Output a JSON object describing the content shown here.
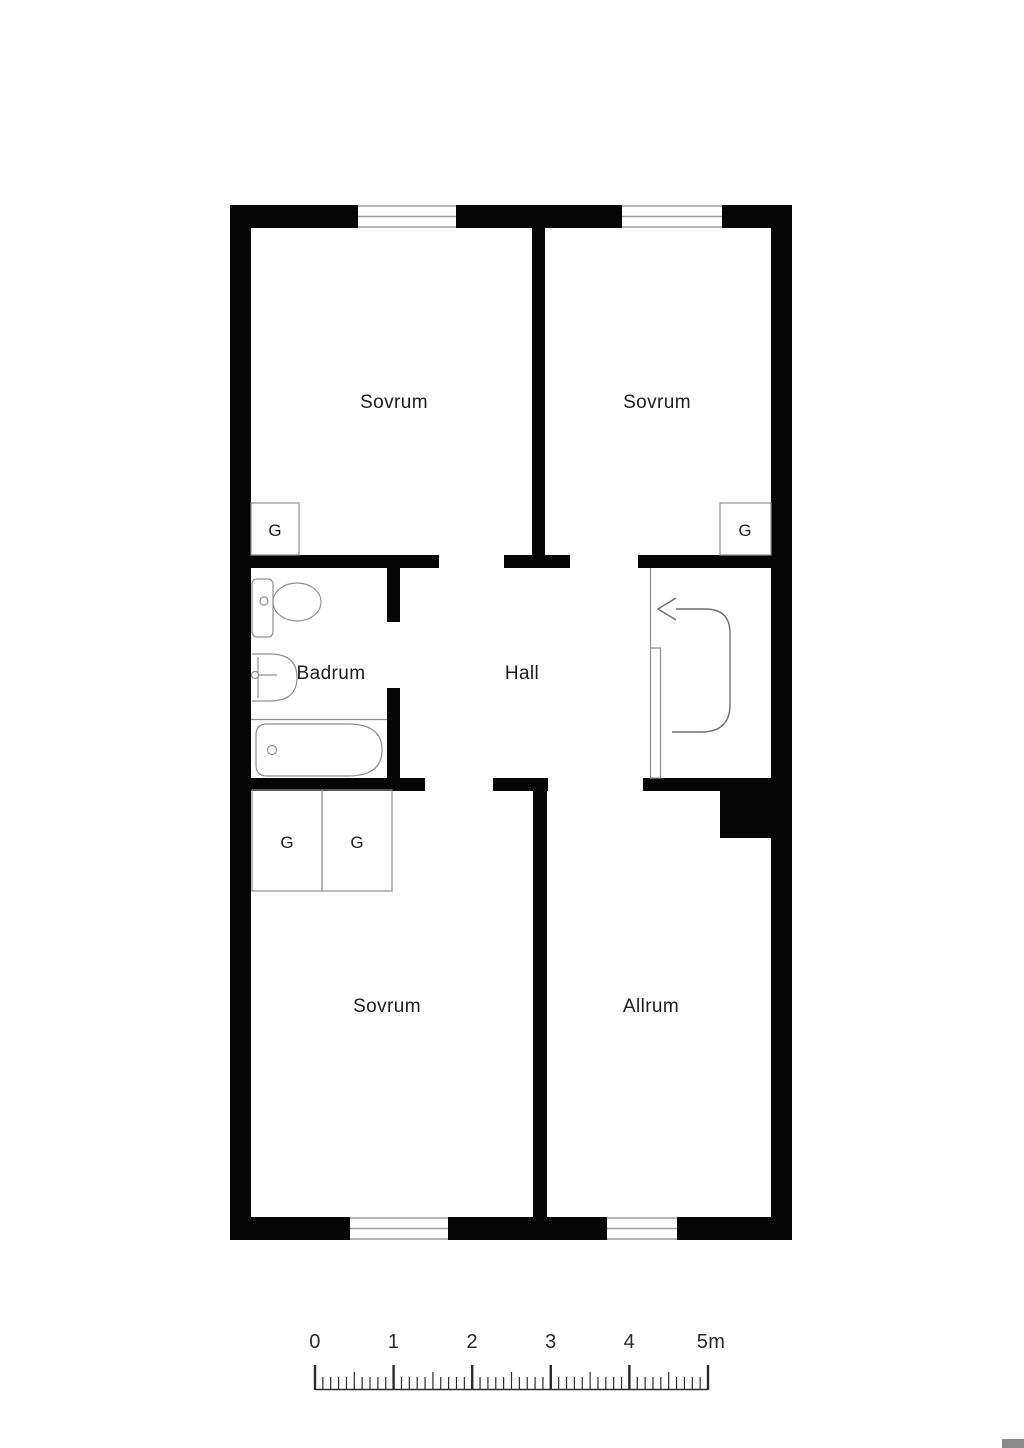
{
  "page": {
    "background": "#ffffff",
    "type_label": "floor plan"
  },
  "floorplan": {
    "rooms": [
      {
        "id": "sovrum-top-left",
        "label": "Sovrum"
      },
      {
        "id": "sovrum-top-right",
        "label": "Sovrum"
      },
      {
        "id": "badrum",
        "label": "Badrum"
      },
      {
        "id": "hall",
        "label": "Hall"
      },
      {
        "id": "sovrum-bottom",
        "label": "Sovrum"
      },
      {
        "id": "allrum",
        "label": "Allrum"
      }
    ],
    "closets": [
      {
        "label": "G"
      },
      {
        "label": "G"
      },
      {
        "label": "G"
      },
      {
        "label": "G"
      }
    ],
    "fixtures": [
      "toilet",
      "sink",
      "bathtub",
      "entrance-arrow",
      "entrance-door"
    ],
    "entrance": {
      "arrow_direction": "left"
    },
    "colors": {
      "wall": "#050505",
      "thin_line": "#909090",
      "text": "#1d1d1d",
      "ruler": "#2b2b2b",
      "corner_block": "#8a8a8a"
    }
  },
  "scale_bar": {
    "unit": "m",
    "tick_labels": [
      "0",
      "1",
      "2",
      "3",
      "4",
      "5m"
    ],
    "major_values": [
      0,
      1,
      2,
      3,
      4,
      5
    ],
    "minor_per_major": 10
  }
}
